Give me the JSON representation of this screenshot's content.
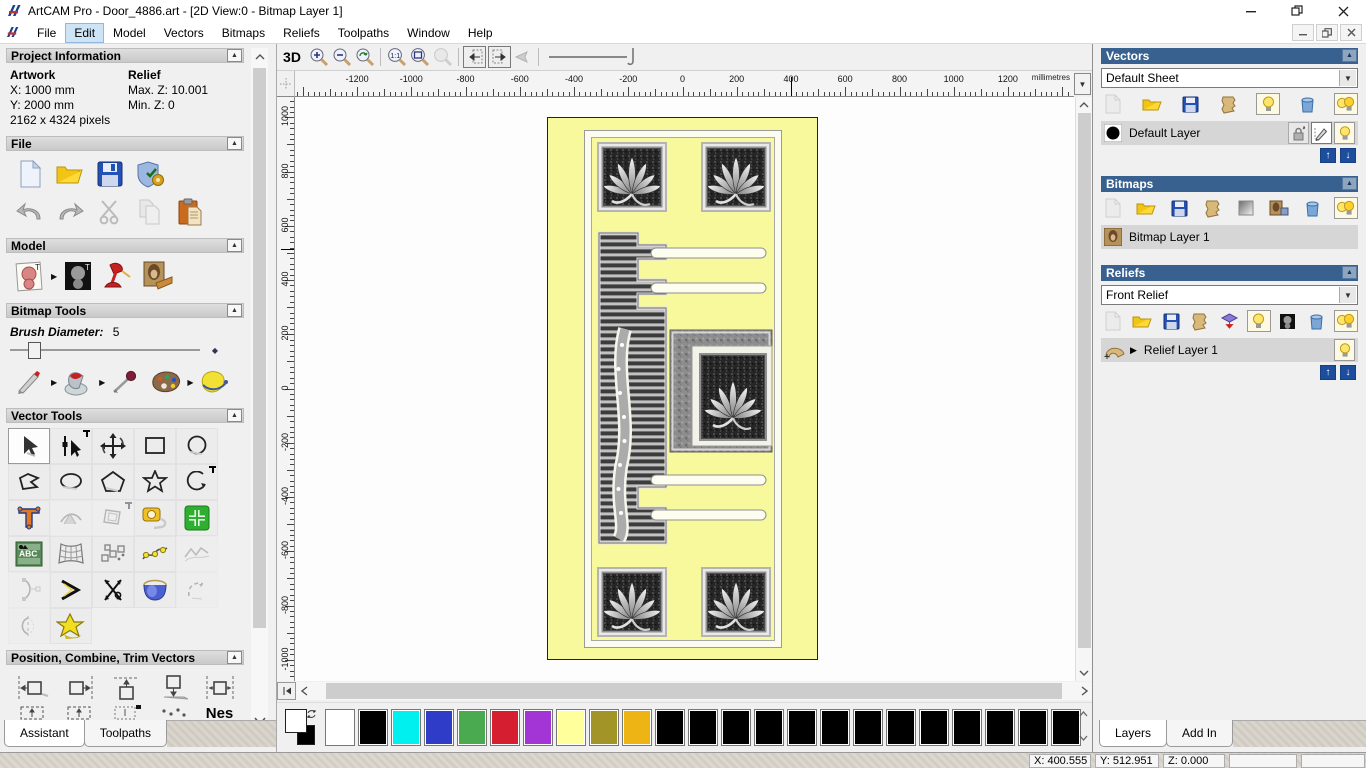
{
  "window": {
    "title": "ArtCAM Pro - Door_4886.art - [2D View:0 - Bitmap Layer 1]"
  },
  "menu": {
    "items": [
      "File",
      "Edit",
      "Model",
      "Vectors",
      "Bitmaps",
      "Reliefs",
      "Toolpaths",
      "Window",
      "Help"
    ],
    "active_item": "Edit"
  },
  "assistant": {
    "tabs": {
      "assistant": "Assistant",
      "toolpaths": "Toolpaths"
    },
    "project_information": {
      "title": "Project Information",
      "artwork_label": "Artwork",
      "relief_label": "Relief",
      "artwork_x": "X: 1000 mm",
      "artwork_y": "Y: 2000 mm",
      "artwork_pixels": "2162 x 4324 pixels",
      "relief_max_z": "Max. Z: 10.001",
      "relief_min_z": "Min. Z: 0"
    },
    "file_section": {
      "title": "File",
      "icons": [
        "new-model",
        "open-model",
        "save-model",
        "model-options",
        "undo",
        "redo",
        "cut",
        "copy",
        "paste"
      ]
    },
    "model_section": {
      "title": "Model",
      "icons": [
        "set-model-size",
        "adjust-model-lighting",
        "set-light-material",
        "load-relief-from-image"
      ]
    },
    "bitmap_tools": {
      "title": "Bitmap Tools",
      "brush_diameter_label": "Brush Diameter:",
      "brush_diameter_value": "5",
      "icons": [
        "paint",
        "flood-fill",
        "pick-colour",
        "colour-palette",
        "reduce-colours"
      ]
    },
    "vector_tools": {
      "title": "Vector Tools",
      "icons": [
        "select-vectors",
        "node-editing",
        "transform-vectors",
        "create-rectangle",
        "create-circle",
        "create-polyline",
        "create-ellipse",
        "create-polygon",
        "create-star",
        "create-arc",
        "create-text",
        "text-on-curve",
        "offset-vector",
        "measure",
        "vector-doctor-plus",
        "paste-text-block",
        "envelope-distortion",
        "block-paste",
        "fit-arcs",
        "fit-polyline",
        "arc-editing",
        "join-vectors",
        "trim-vectors",
        "interactive-distortion",
        "close-vector",
        "mirror-vectors",
        "vector-doctor"
      ]
    },
    "position_section": {
      "title": "Position, Combine, Trim Vectors",
      "nesting_label": "Nes",
      "icons": [
        "align-left",
        "align-right",
        "align-top",
        "align-bottom",
        "align-centre",
        "block-copy",
        "block-copy-2",
        "block-copy-3",
        "scatter-copy",
        "nesting"
      ]
    }
  },
  "view": {
    "toolbar": {
      "view_3d_label": "3D",
      "icons": [
        "zoom-in",
        "zoom-out",
        "zoom-previous",
        "zoom-1to1",
        "zoom-fit",
        "zoom-selected",
        "view-previous-vector",
        "view-next-vector",
        "pan-view",
        "smoothness-slider"
      ]
    },
    "ruler": {
      "unit_label": "millimetres",
      "top_labels": [
        -1200,
        -1000,
        -800,
        -600,
        -400,
        -200,
        0,
        200,
        400,
        600,
        800,
        1000,
        1200
      ],
      "left_labels": [
        1000,
        800,
        600,
        400,
        200,
        0,
        -200,
        -400,
        -600,
        -800,
        -1000
      ]
    },
    "cursor": {
      "x_mm": 400.555,
      "y_mm": 512.951
    }
  },
  "palette": {
    "primary_colour": "#ffffff",
    "secondary_colour": "#000000",
    "swatches": [
      "#ffffff",
      "#000000",
      "#00f0f0",
      "#2e3cc8",
      "#4aaa50",
      "#d51f30",
      "#a335d6",
      "#ffff9c",
      "#a39428",
      "#eeb414",
      "#000000",
      "#000000",
      "#000000",
      "#000000",
      "#000000",
      "#000000",
      "#000000",
      "#000000",
      "#000000",
      "#000000",
      "#000000",
      "#000000",
      "#000000"
    ]
  },
  "layers_panel": {
    "vectors": {
      "title": "Vectors",
      "sheet_value": "Default Sheet",
      "layer_name": "Default Layer",
      "layer_colour": "#000000",
      "icons": [
        "new-layer",
        "open-layer",
        "save-layer",
        "merge-layers",
        "toggle-visibility",
        "delete-layer",
        "toggle-all-visibility"
      ]
    },
    "bitmaps": {
      "title": "Bitmaps",
      "layer_name": "Bitmap Layer 1",
      "icons": [
        "new-layer",
        "open-layer",
        "save-layer",
        "merge-layers",
        "clear-layer",
        "new-from-image",
        "delete-layer",
        "toggle-all-visibility"
      ]
    },
    "reliefs": {
      "title": "Reliefs",
      "relief_value": "Front Relief",
      "layer_name": "Relief Layer 1",
      "icons": [
        "new-layer",
        "open-layer",
        "save-layer",
        "merge-layers",
        "transfer-relief",
        "toggle-visibility",
        "greyscale-from-relief",
        "delete-layer",
        "toggle-all-visibility"
      ]
    },
    "tabs": {
      "layers": "Layers",
      "add_in": "Add In"
    }
  },
  "statusbar": {
    "x": "X: 400.555",
    "y": "Y: 512.951",
    "z": "Z: 0.000"
  }
}
